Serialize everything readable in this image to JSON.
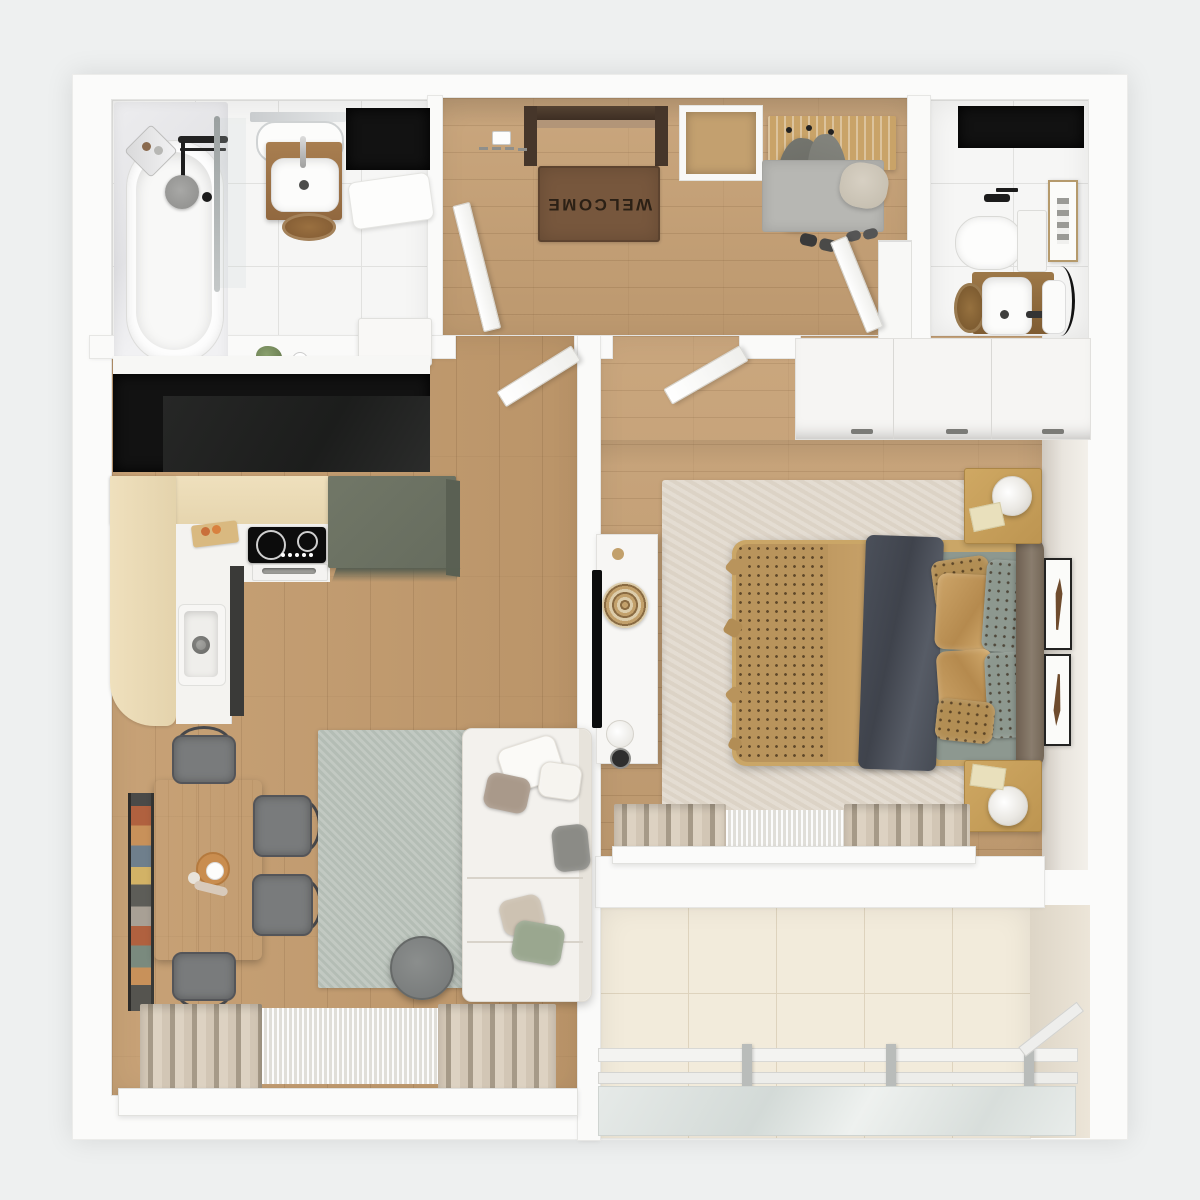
{
  "scene": {
    "type": "apartment-floor-plan-3d-top-view",
    "style": "photorealistic-render",
    "background_color": "#eef0f0"
  },
  "labels": {
    "welcome_mat": "WELCOME"
  },
  "palette": {
    "wall": "#fafaf9",
    "wood_floor": "#c49c6e",
    "bathroom_tile": "#f6f6f5",
    "balcony_tile": "#f2ebdb",
    "pale_counter": "#ecdcb8",
    "green_cabinet": "#6c7264",
    "dark_niche": "#121212",
    "living_rug": "#b4bdb5",
    "bedroom_rug": "#dcd3c6",
    "welcome_mat_brown": "#77573d",
    "bedspread_tan": "#c09a62",
    "blanket_slate": "#4b505a",
    "headboard_brown": "#857766",
    "sofa_white": "#f3f1ed",
    "curtain_beige": "#cfc3b2"
  },
  "rooms": [
    {
      "name": "bathroom",
      "position": "top-left",
      "furniture": [
        "bathtub",
        "shower fixture",
        "corner shelf",
        "glass screen",
        "vanity sink",
        "mirror",
        "wicker stool",
        "bath mat",
        "cabinet",
        "plant",
        "black niche"
      ]
    },
    {
      "name": "entry-hall",
      "position": "top-center",
      "furniture": [
        "entry door",
        "welcome mat",
        "key hooks",
        "wall niche",
        "coat rack",
        "hanging coats",
        "entry mat",
        "pouf",
        "shoes",
        "tall cabinet",
        "bathroom door",
        "wc door"
      ]
    },
    {
      "name": "wc",
      "position": "top-right",
      "furniture": [
        "toilet",
        "vanity sink",
        "mirror",
        "wicker basket",
        "wall art",
        "black niche"
      ]
    },
    {
      "name": "kitchen",
      "position": "middle-left",
      "furniture": [
        "dark counter niche",
        "L-shaped counter",
        "cutting board",
        "induction cooktop",
        "oven",
        "kitchen sink",
        "tall green cabinet"
      ]
    },
    {
      "name": "living-room",
      "position": "bottom-left",
      "furniture": [
        "dining table",
        "four chairs",
        "book ledge",
        "area rug",
        "corner sofa",
        "throw pillows",
        "round coffee table",
        "curtains",
        "sheer curtain",
        "window sill"
      ]
    },
    {
      "name": "bedroom",
      "position": "middle-right",
      "furniture": [
        "wardrobe",
        "open door",
        "double bed",
        "dotted bedspread",
        "throw blanket",
        "pillows",
        "headboard",
        "two nightstands",
        "table lamps",
        "tv console",
        "tv",
        "decor tray",
        "vase",
        "area rug",
        "feather prints",
        "curtains",
        "window sill"
      ]
    },
    {
      "name": "balcony",
      "position": "bottom-right",
      "furniture": [
        "tiled floor",
        "glass railing",
        "railing posts"
      ]
    }
  ]
}
